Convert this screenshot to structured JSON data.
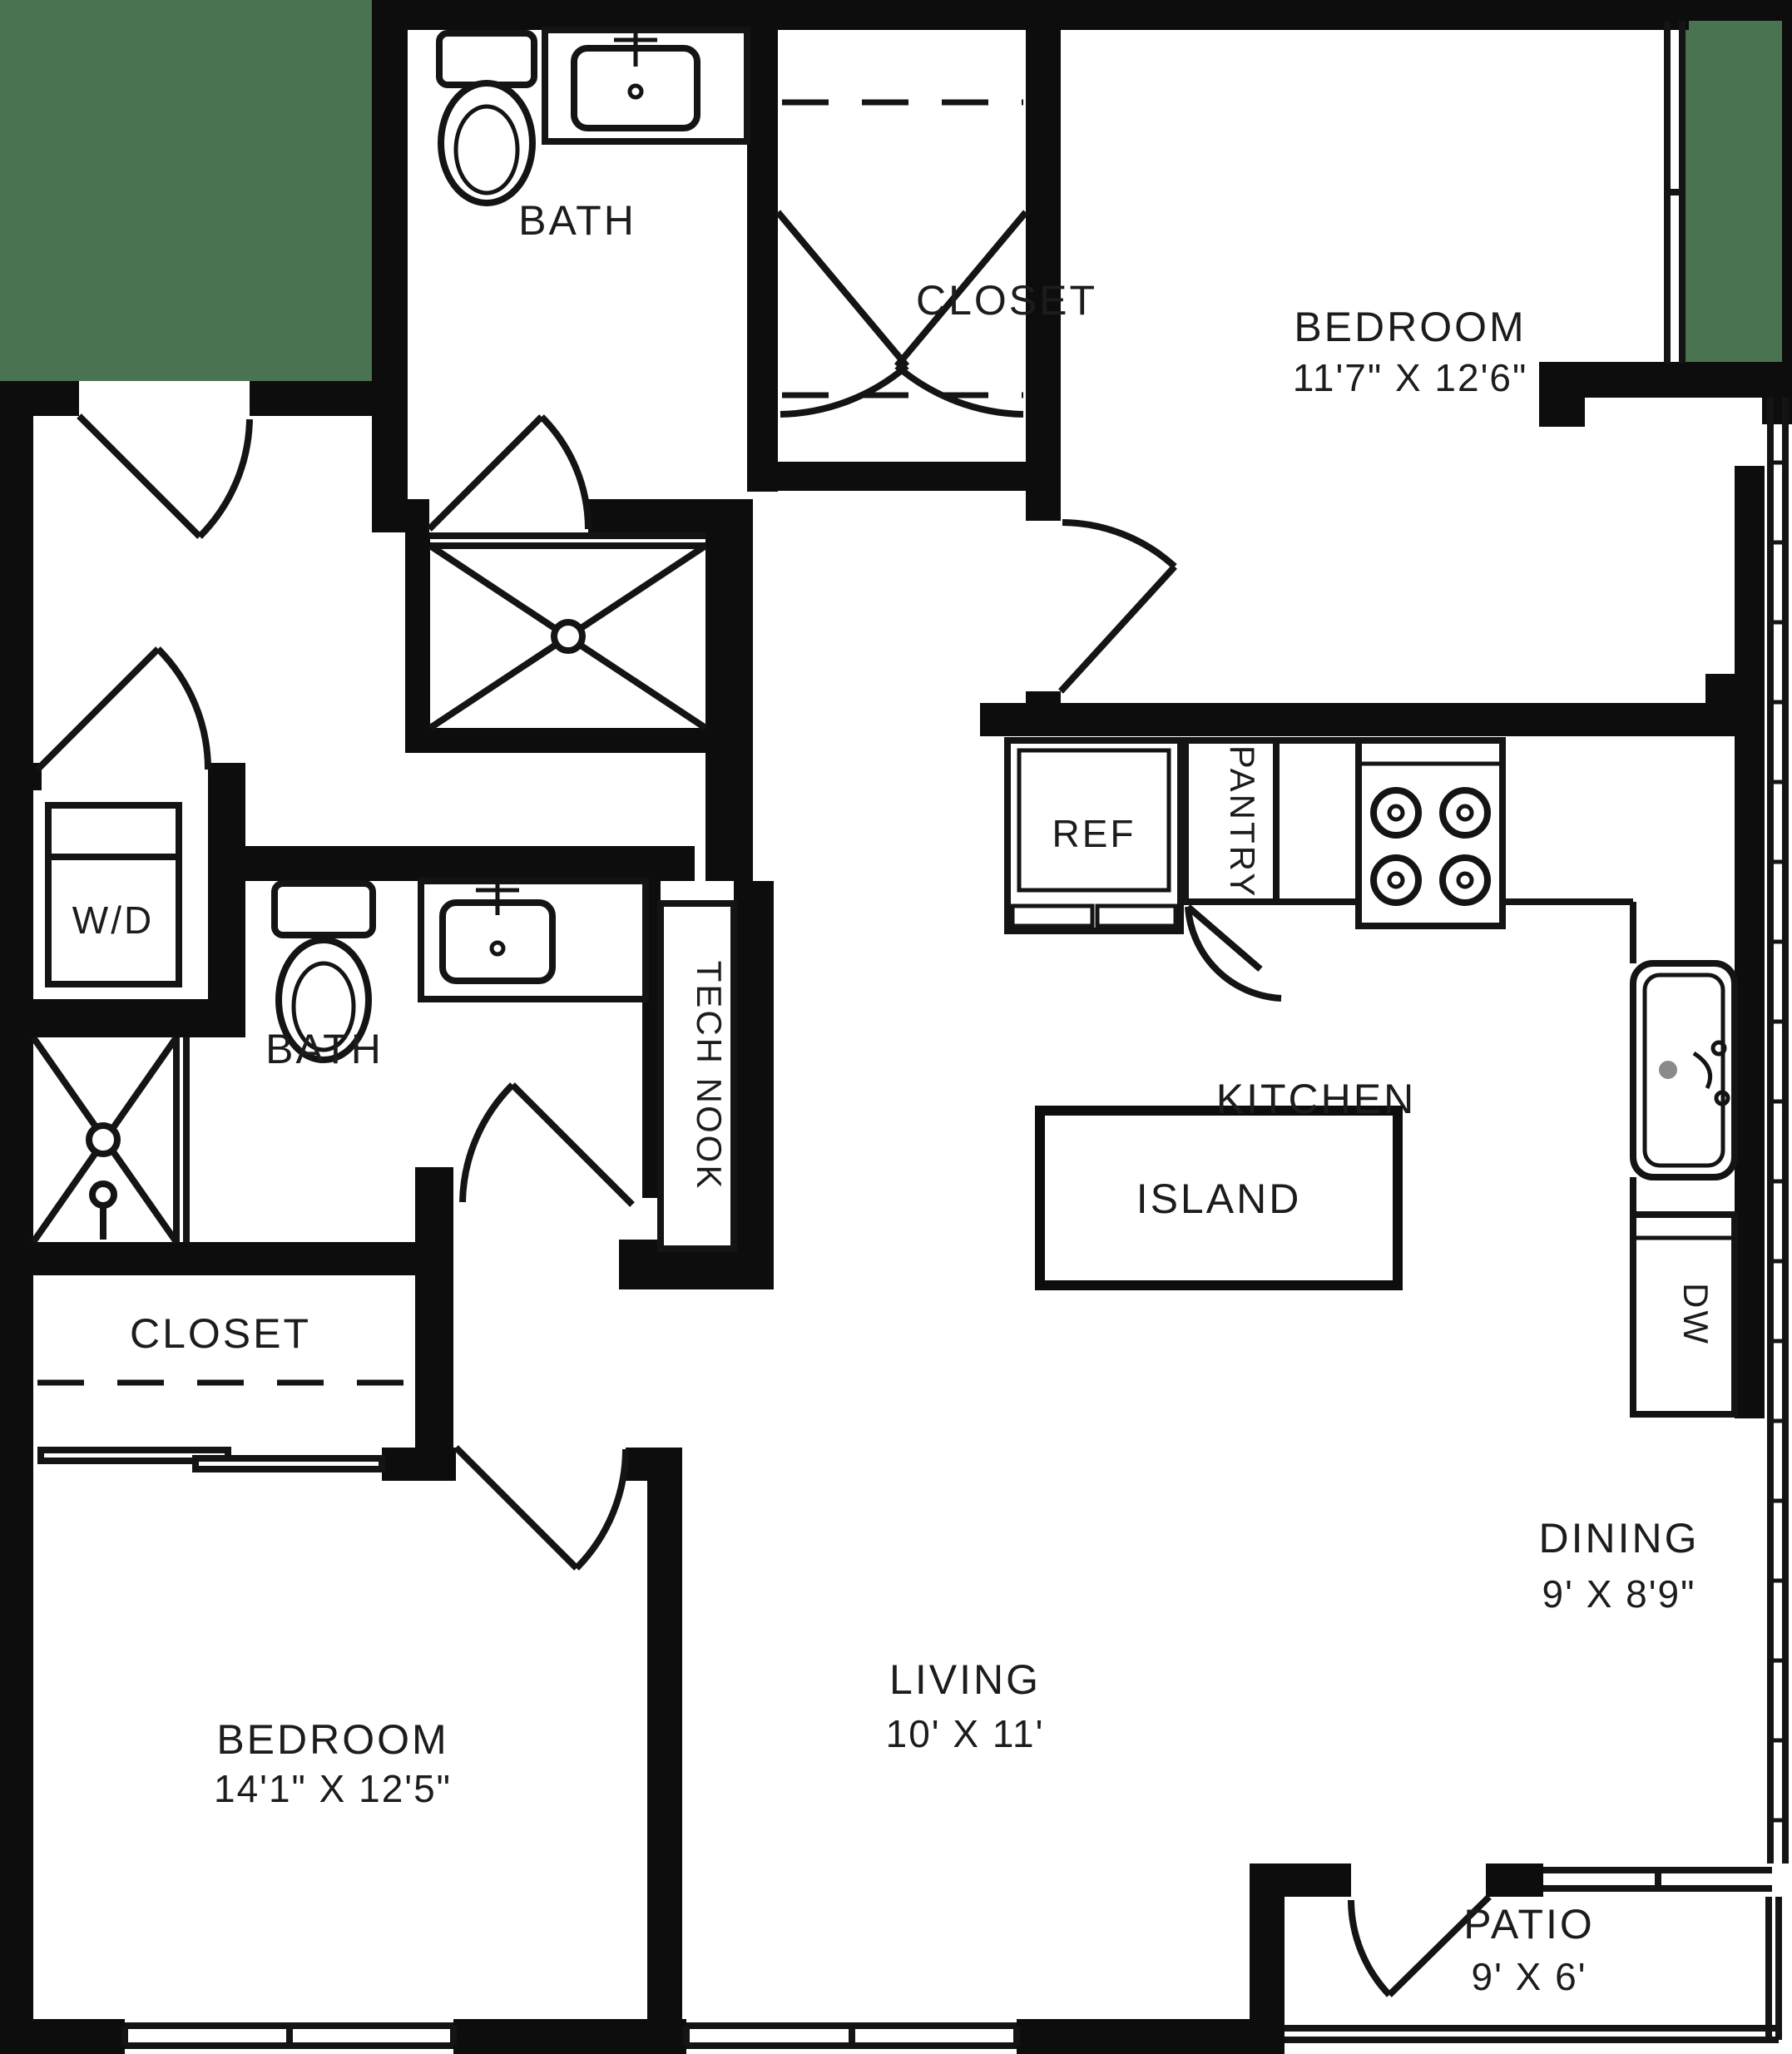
{
  "floorplan": {
    "colors": {
      "wall": "#0d0d0d",
      "exterior_green": "#4A7352",
      "line": "#141414",
      "background": "#ffffff"
    },
    "rooms": {
      "bath_top": {
        "name": "BATH"
      },
      "closet_top": {
        "name": "CLOSET"
      },
      "bedroom_right": {
        "name": "BEDROOM",
        "dims": "11'7\" X 12'6\""
      },
      "bath_mid": {
        "name": "BATH"
      },
      "tech_nook": {
        "name": "TECH NOOK"
      },
      "kitchen": {
        "name": "KITCHEN"
      },
      "island": {
        "name": "ISLAND"
      },
      "closet_mid": {
        "name": "CLOSET"
      },
      "bedroom_left": {
        "name": "BEDROOM",
        "dims": "14'1\" X 12'5\""
      },
      "living": {
        "name": "LIVING",
        "dims": "10' X 11'"
      },
      "dining": {
        "name": "DINING",
        "dims": "9' X 8'9\""
      },
      "patio": {
        "name": "PATIO",
        "dims": "9' X 6'"
      }
    },
    "fixtures": {
      "washer_dryer": "W/D",
      "refrigerator": "REF",
      "pantry": "PANTRY",
      "dishwasher": "DW"
    }
  }
}
